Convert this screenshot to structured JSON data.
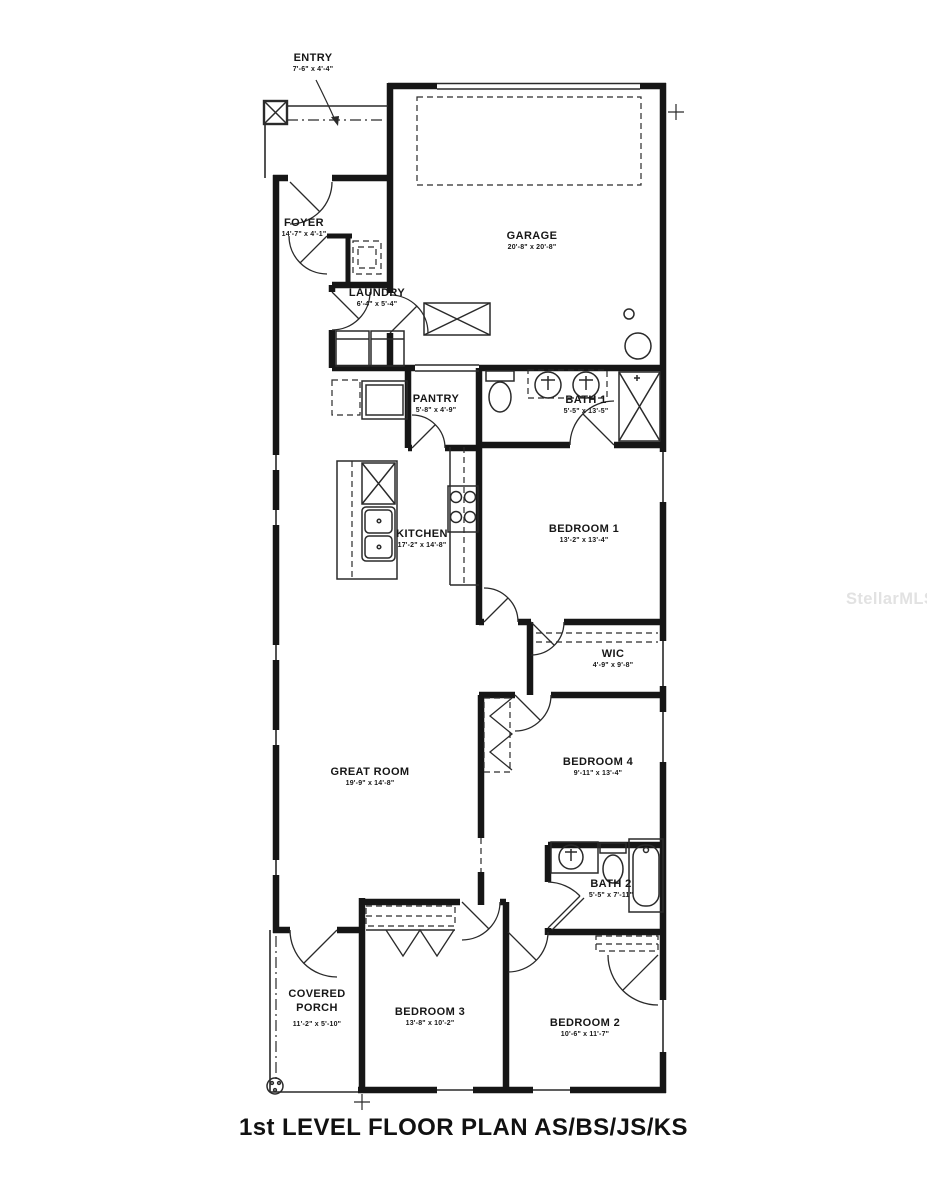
{
  "title": "1st LEVEL FLOOR PLAN AS/BS/JS/KS",
  "watermark": "StellarMLS",
  "colors": {
    "wall": "#161616",
    "thin": "#2a2a2a",
    "watermark": "#e2e2e2"
  },
  "rooms": {
    "entry": {
      "name": "ENTRY",
      "dims": "7'-6\" x 4'-4\""
    },
    "foyer": {
      "name": "FOYER",
      "dims": "14'-7\" x 4'-1\""
    },
    "garage": {
      "name": "GARAGE",
      "dims": "20'-8\" x 20'-8\""
    },
    "laundry": {
      "name": "LAUNDRY",
      "dims": "6'-4\" x 5'-4\""
    },
    "pantry": {
      "name": "PANTRY",
      "dims": "5'-8\" x 4'-9\""
    },
    "bath1": {
      "name": "BATH 1",
      "dims": "5'-5\" x 13'-5\""
    },
    "kitchen": {
      "name": "KITCHEN",
      "dims": "17'-2\" x 14'-8\""
    },
    "bedroom1": {
      "name": "BEDROOM 1",
      "dims": "13'-2\" x 13'-4\""
    },
    "wic": {
      "name": "WIC",
      "dims": "4'-9\" x 9'-8\""
    },
    "great_room": {
      "name": "GREAT ROOM",
      "dims": "19'-9\" x 14'-8\""
    },
    "bedroom4": {
      "name": "BEDROOM 4",
      "dims": "9'-11\" x 13'-4\""
    },
    "bath2": {
      "name": "BATH 2",
      "dims": "5'-5\" x 7'-11\""
    },
    "covered_porch": {
      "name": "COVERED PORCH",
      "dims": "11'-2\" x 5'-10\""
    },
    "bedroom3": {
      "name": "BEDROOM 3",
      "dims": "13'-8\" x 10'-2\""
    },
    "bedroom2": {
      "name": "BEDROOM 2",
      "dims": "10'-6\" x 11'-7\""
    }
  }
}
